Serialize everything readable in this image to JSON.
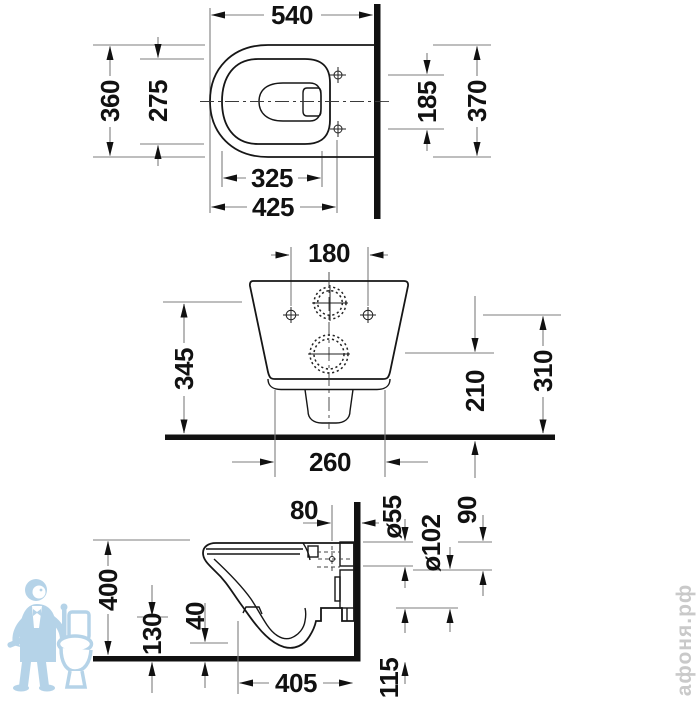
{
  "background": "#ffffff",
  "colors": {
    "part_outline": "#161616",
    "wall_floor_section": "#111111",
    "dimension_lines": "#7d7d7d",
    "dimension_text": "#111111",
    "watermark_text": "#c9c9c9",
    "mascot_blue": "#aecfe6"
  },
  "views": {
    "plan": {
      "dims": {
        "overall_width": "540",
        "overall_depth": "360",
        "rim_inner_depth": "275",
        "fixing_holes_spacing": "185",
        "body_depth": "370",
        "rim_inner_length": "325",
        "front_to_fixing_holes": "425"
      }
    },
    "rear": {
      "dims": {
        "fixing_holes_spacing": "180",
        "body_height": "345",
        "outlet_center_height": "210",
        "fixing_holes_height": "310",
        "body_bottom_width": "260"
      }
    },
    "side": {
      "dims": {
        "flush_inlet_depth": "80",
        "flush_pipe_diameter": "ø55",
        "outlet_pipe_diameter": "ø102",
        "pipe_spacing": "90",
        "top_height": "400",
        "underside_height": "130",
        "front_underside_height": "40",
        "depth_from_wall": "405",
        "outlet_bottom_height": "115"
      }
    }
  },
  "watermark": {
    "site": "афоня.рф",
    "mascot": "plumber-with-toilet"
  }
}
